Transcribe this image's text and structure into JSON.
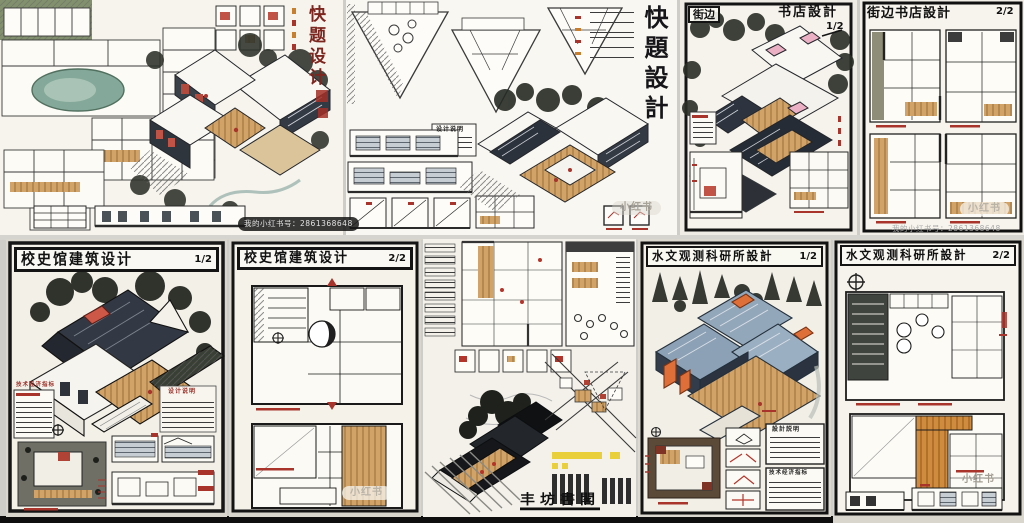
{
  "canvas": {
    "width": 1024,
    "height": 523
  },
  "watermarks": {
    "brand": "小红书",
    "account_line": "我的小红书号：2861368648"
  },
  "labels": {
    "design_notes": "设计说明",
    "design_notes_trad": "設計説明",
    "tech_index": "技术经济指标"
  },
  "boards": [
    {
      "key": "quick-design-1",
      "title": "快题设计",
      "title_layout": "vertical",
      "title_color": "#7d2620"
    },
    {
      "key": "quick-design-2",
      "title": "快題設計",
      "title_layout": "vertical",
      "title_color": "#16161a"
    },
    {
      "key": "street-bookstore-1",
      "title_prefix": "街边",
      "title_suffix": "书店設計",
      "sheet": "1/2"
    },
    {
      "key": "street-bookstore-2",
      "title": "街边书店設計",
      "sheet": "2/2"
    },
    {
      "key": "school-history-museum-1",
      "title": "校史馆建筑设计",
      "sheet": "1/2"
    },
    {
      "key": "school-history-museum-2",
      "title": "校史馆建筑设计",
      "sheet": "2/2"
    },
    {
      "key": "dense-renovation-board",
      "stylized_title": "丰坊書閣"
    },
    {
      "key": "hydrology-institute-1",
      "title": "水文观测科研所設計",
      "sheet": "1/2"
    },
    {
      "key": "hydrology-institute-2",
      "title": "水文观测科研所設計",
      "sheet": "2/2"
    }
  ],
  "colors": {
    "paper": "#f5f2ea",
    "ink": "#141414",
    "red_accent": "#a8342c",
    "wood": "#d1a368",
    "orange": "#de6f39",
    "roof_blue": "#93a7ba",
    "navy_wall": "#2b3340",
    "pink": "#ecb0c4",
    "pond_teal": "#84a99a",
    "highlight_yellow": "#e9cf3a",
    "foliage": "#262a22"
  }
}
